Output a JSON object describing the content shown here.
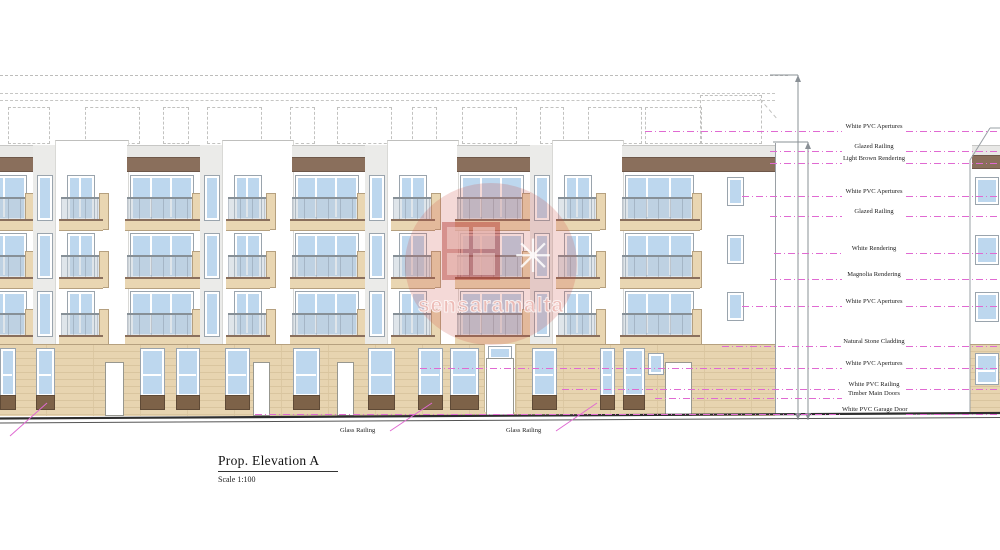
{
  "title_block": {
    "title": "Prop. Elevation A",
    "scale": "Scale 1:100"
  },
  "watermark": {
    "text": "sensaramalta",
    "icon": "✳"
  },
  "annotations": {
    "items": [
      {
        "label": "White PVC Apertures"
      },
      {
        "label": "Glazed Railing"
      },
      {
        "label": "Light Brown Rendering"
      },
      {
        "label": "White PVC Apertures"
      },
      {
        "label": "Glazed Railing"
      },
      {
        "label": "White Rendering"
      },
      {
        "label": "Magnolia Rendering"
      },
      {
        "label": "White PVC Apertures"
      },
      {
        "label": "Natural Stone Cladding"
      },
      {
        "label": "White PVC Apertures"
      },
      {
        "label": "White PVC Railing"
      },
      {
        "label": "Timber Main Doors"
      },
      {
        "label": "White PVC Garage Door"
      }
    ]
  },
  "ground_labels": {
    "items": [
      {
        "label": "Glass Railing"
      },
      {
        "label": "Glass Railing"
      },
      {
        "label": "Glass Railing"
      }
    ]
  },
  "colors": {
    "leader_pink": "#e06ad2",
    "brown_band": "#8a6f5c",
    "slab_tan": "#e9d6b2",
    "stone_cladding": "#e7d4b0",
    "window_blue": "#bdd7ee",
    "panel_brown": "#7d6248",
    "watermark_red": "#cd5048",
    "ground_line": "#2e2e2e"
  }
}
